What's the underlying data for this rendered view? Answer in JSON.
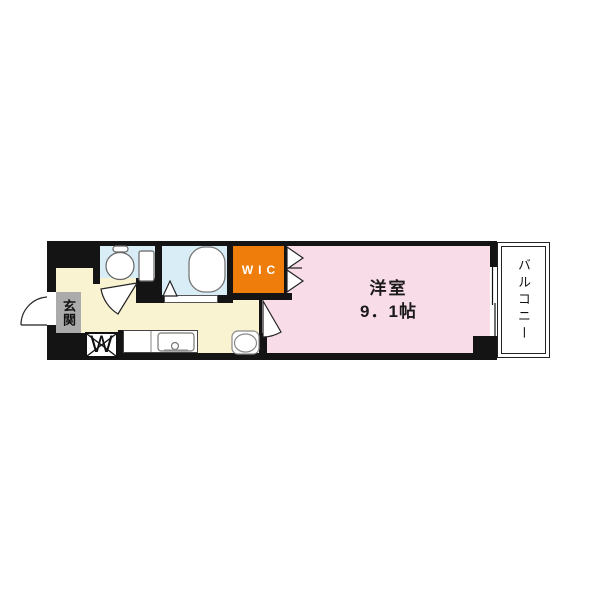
{
  "plan": {
    "type": "apartment-floor-plan",
    "rooms": {
      "entrance": {
        "label": "玄関"
      },
      "toilet": {
        "label": ""
      },
      "bathroom": {
        "label": ""
      },
      "wic": {
        "label": "WIC"
      },
      "western_room": {
        "label": "洋室",
        "size_line": "9．1帖"
      },
      "balcony": {
        "label": "バルコニー"
      },
      "washer_space": {
        "label": "W"
      }
    },
    "fixtures": [
      "toilet",
      "bathtub",
      "kitchen-sink",
      "stove",
      "washing-machine-space",
      "entry-door-swing",
      "toilet-door-swing",
      "bathroom-folding-door",
      "room-door-swing",
      "closet-folding-door",
      "sliding-window"
    ],
    "colors": {
      "walls": "#141414",
      "hall_kitchen_floor": "#faf3d2",
      "wet_area_floor": "#d9edf6",
      "wic_fill": "#ee7d0c",
      "western_room_floor": "#f8dce8",
      "entrance_box": "#ababab",
      "background": "#ffffff"
    }
  }
}
